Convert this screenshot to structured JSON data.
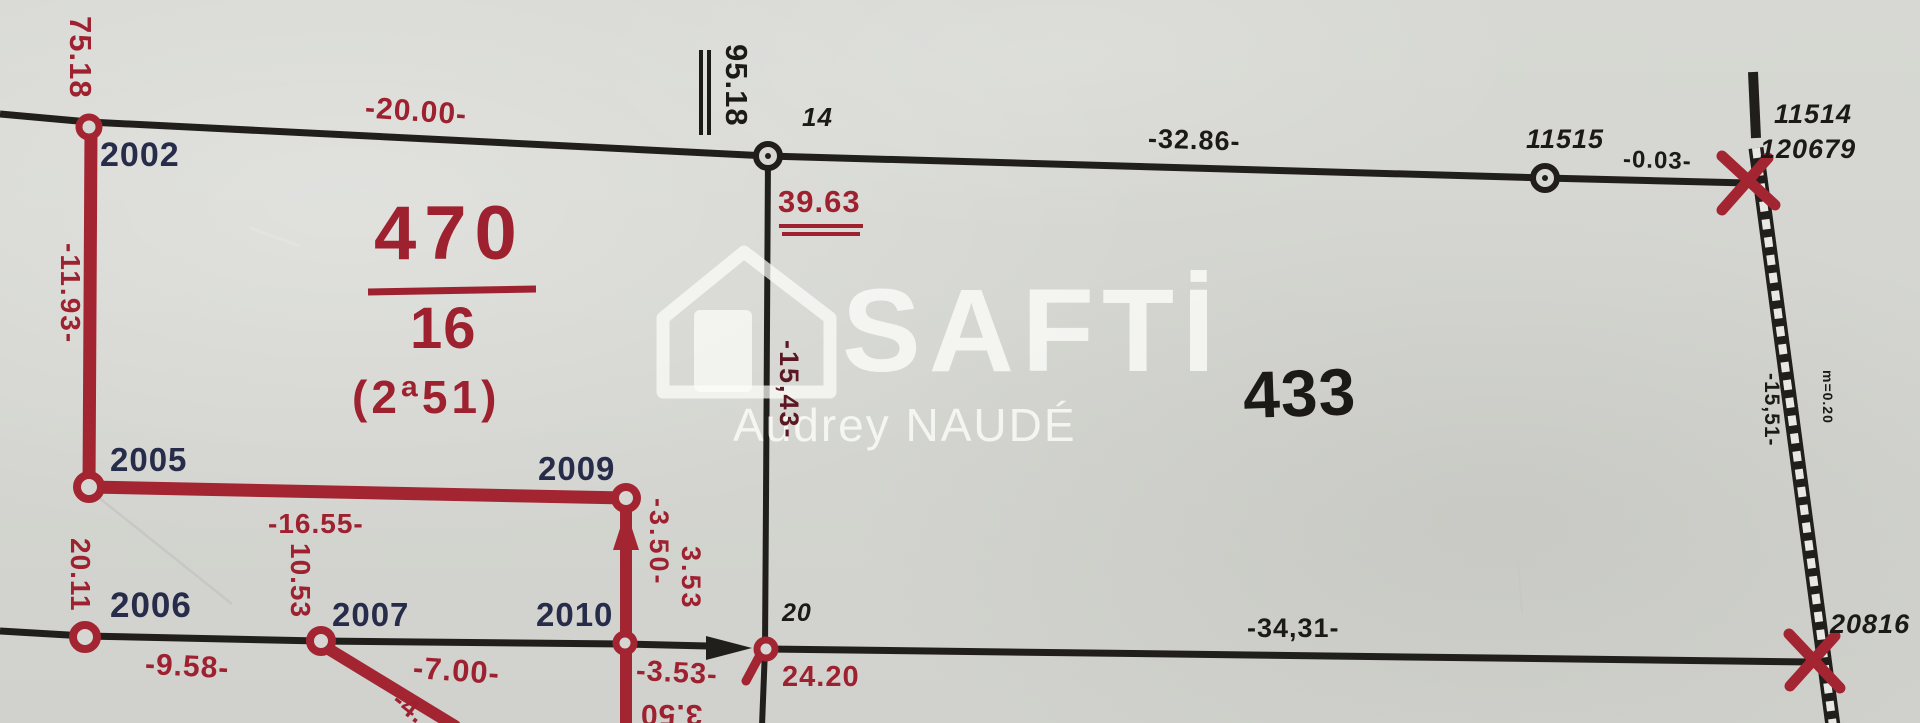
{
  "watermark": {
    "brand": "SAFTİ",
    "agent": "Audrey NAUDÉ"
  },
  "parcels": {
    "main": {
      "number": "470",
      "index": "16",
      "area": "(2ª51)"
    },
    "adjacent": {
      "number": "433"
    }
  },
  "points": {
    "p2002": "2002",
    "p2005": "2005",
    "p2006": "2006",
    "p2007": "2007",
    "p2009": "2009",
    "p2010": "2010",
    "p14": "14",
    "p20": "20",
    "p11515": "11515",
    "p11514": "11514",
    "p120679": "120679",
    "p20816": "20816"
  },
  "measurements": {
    "left_top": "75.18",
    "left_upper": "-11.93-",
    "top_west": "-20.00-",
    "top_axis": "95.18",
    "axis_south": "39.63",
    "top_east": "-32.86-",
    "top_far_east": "-0.03-",
    "mid_left": "-16.55-",
    "mid_left_vert": "10.53",
    "left_lower": "20.11",
    "bottom_w1": "-9.58-",
    "bottom_w2": "-7.00-",
    "bottom_w3": "-3.53-",
    "bottom_w4": "24.20",
    "bottom_flipped": "3.50",
    "diag_partial": "-4.",
    "stub_a": "-3.50-",
    "stub_b": "3.53",
    "axis_mid": "-15,43-",
    "bottom_east": "-34,31-",
    "right_side": "-15,51-",
    "right_note": "m=0.20"
  }
}
